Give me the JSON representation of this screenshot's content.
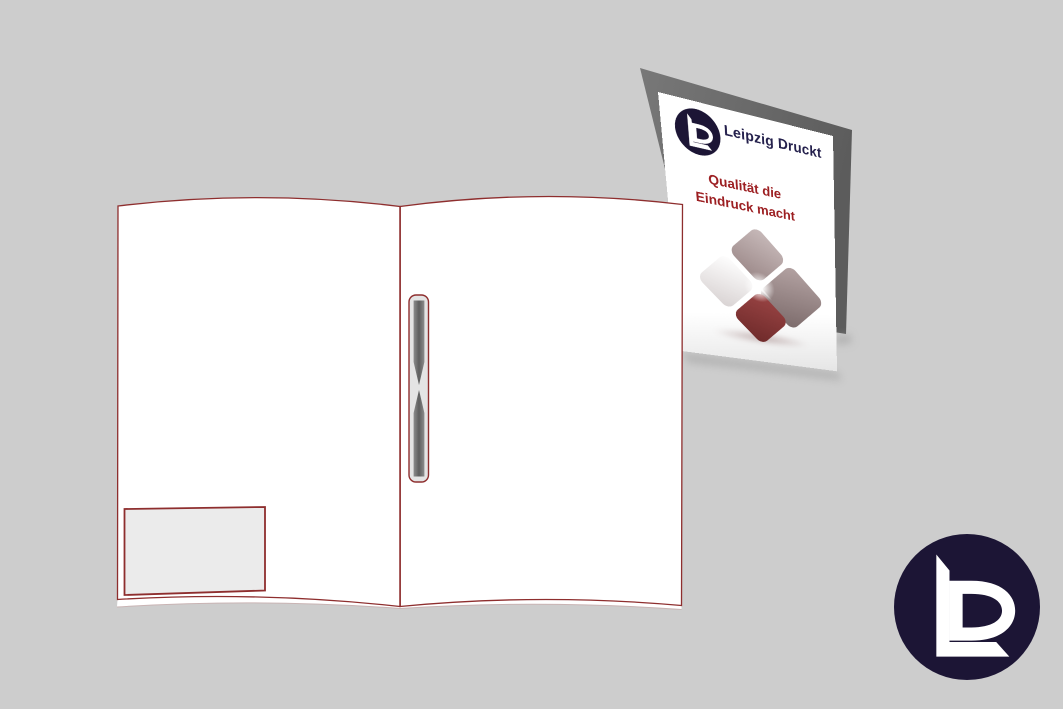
{
  "theme": {
    "bg": "#cdcdcd",
    "outline": "#8e2e2e",
    "navy": "#24204c",
    "red": "#9c1e21",
    "circle": "#1c1535",
    "grayback1": "#787878",
    "grayback2": "#5c5c5c",
    "pocketfill": "#ebebeb",
    "slotfill": "#e4e4e4",
    "strip1": "#8c8c8c",
    "strip2": "#5e5e5e"
  },
  "brochure": {
    "brand_name": "Leipzig Druckt",
    "tagline_line1": "Qualität die",
    "tagline_line2": "Eindruck macht",
    "panel_color": "#ffffff",
    "back_panel_color": "#6f6f6f",
    "diamond_colors": {
      "top": "#a99595",
      "left": "#f1eded",
      "right": "#968383",
      "bottom": "#7e3232"
    }
  },
  "folder": {
    "page_color": "#ffffff",
    "outline_color": "#8e2e2e",
    "pocket_fill": "#ebebeb",
    "slot_fill": "#e4e4e4",
    "slot_strip_color": "#6a6a6a"
  },
  "logo_badge": {
    "monogram": "LD",
    "circle_color": "#1c1535",
    "mark_color": "#ffffff"
  }
}
